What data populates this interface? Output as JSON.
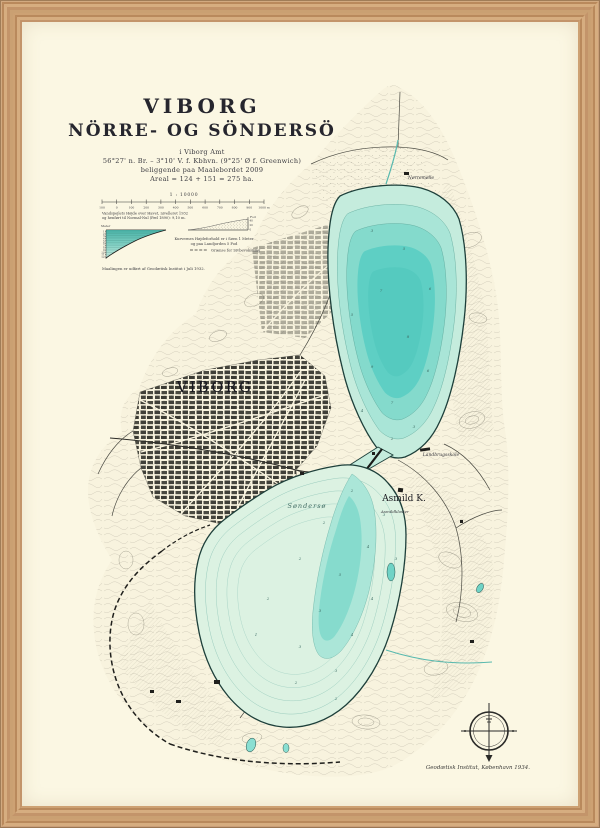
{
  "title": {
    "main": "VIBORG",
    "subtitle": "NÖRRE- OG SÖNDERSÖ",
    "lines": [
      "i Viborg Amt",
      "56°27' n. Br. – 3°10' V. f. Kbhvn. (9°25' Ø f. Greenwich)",
      "beliggende paa Maalebordet 2009",
      "Areal = 124 + 151 = 275 ha."
    ]
  },
  "legend": {
    "scale_label": "1 : 10000",
    "scale_ticks": [
      "100",
      "0",
      "100",
      "200",
      "300",
      "400",
      "500",
      "600",
      "700",
      "800",
      "900",
      "1000 m"
    ],
    "water_note_1": "Vandspejlets Højde over Havet, nivelleret 1932",
    "water_note_2": "og henført til Normal-Nul (Pæl 1890): 9,10 m.",
    "meter_label": "Meter",
    "fod_label": "Fod",
    "depth_axis_labels": [
      "1",
      "2",
      "3",
      "4",
      "5",
      "6",
      "7",
      "8",
      "9",
      "10",
      "11",
      "12"
    ],
    "elev_axis_labels": [
      "40",
      "20",
      "0"
    ],
    "curve_note_1": "Kurvernes Højdeforhold er i Søen 1 Meter",
    "curve_note_2": "og paa Landjorden 5 Fod",
    "dashed_note": "Grænse for Sivbevoksning",
    "survey_note": "Maalingen er udført af Geodætisk Institut i Juli 1932."
  },
  "map": {
    "city_label": "VIBORG",
    "church_label": "Asmild K.",
    "school_label": "Landbrugsskole",
    "kloster_label": "Asmildkloster",
    "mill_label": "Nørremølle",
    "lake_label": "Søndersø",
    "depth_markers": [
      {
        "x": 372,
        "y": 232,
        "v": "3"
      },
      {
        "x": 404,
        "y": 250,
        "v": "5"
      },
      {
        "x": 430,
        "y": 290,
        "v": "6"
      },
      {
        "x": 381,
        "y": 292,
        "v": "7"
      },
      {
        "x": 352,
        "y": 316,
        "v": "5"
      },
      {
        "x": 408,
        "y": 338,
        "v": "8"
      },
      {
        "x": 372,
        "y": 368,
        "v": "9"
      },
      {
        "x": 428,
        "y": 372,
        "v": "6"
      },
      {
        "x": 392,
        "y": 404,
        "v": "7"
      },
      {
        "x": 362,
        "y": 412,
        "v": "4"
      },
      {
        "x": 414,
        "y": 428,
        "v": "3"
      },
      {
        "x": 392,
        "y": 440,
        "v": "2"
      },
      {
        "x": 352,
        "y": 492,
        "v": "2"
      },
      {
        "x": 384,
        "y": 516,
        "v": "3"
      },
      {
        "x": 324,
        "y": 524,
        "v": "2"
      },
      {
        "x": 368,
        "y": 548,
        "v": "4"
      },
      {
        "x": 396,
        "y": 560,
        "v": "3"
      },
      {
        "x": 340,
        "y": 576,
        "v": "5"
      },
      {
        "x": 300,
        "y": 560,
        "v": "2"
      },
      {
        "x": 372,
        "y": 600,
        "v": "4"
      },
      {
        "x": 320,
        "y": 612,
        "v": "3"
      },
      {
        "x": 268,
        "y": 600,
        "v": "2"
      },
      {
        "x": 352,
        "y": 636,
        "v": "4"
      },
      {
        "x": 300,
        "y": 648,
        "v": "3"
      },
      {
        "x": 256,
        "y": 636,
        "v": "1"
      },
      {
        "x": 336,
        "y": 672,
        "v": "3"
      },
      {
        "x": 296,
        "y": 684,
        "v": "2"
      },
      {
        "x": 336,
        "y": 700,
        "v": "2"
      }
    ]
  },
  "credit": "Geodætisk Institut, København 1934.",
  "colors": {
    "paper": "#fbf7e3",
    "frame_wood": "#c89c6e",
    "lake_deep": "#5ecfc4",
    "lake_mid": "#84dacc",
    "lake_light": "#a9e5d7",
    "lake_pale": "#dcf2e2",
    "lake_outline": "#1d3f3a",
    "ink": "#2e2e35",
    "terrain_line": "#8f8c7d"
  }
}
